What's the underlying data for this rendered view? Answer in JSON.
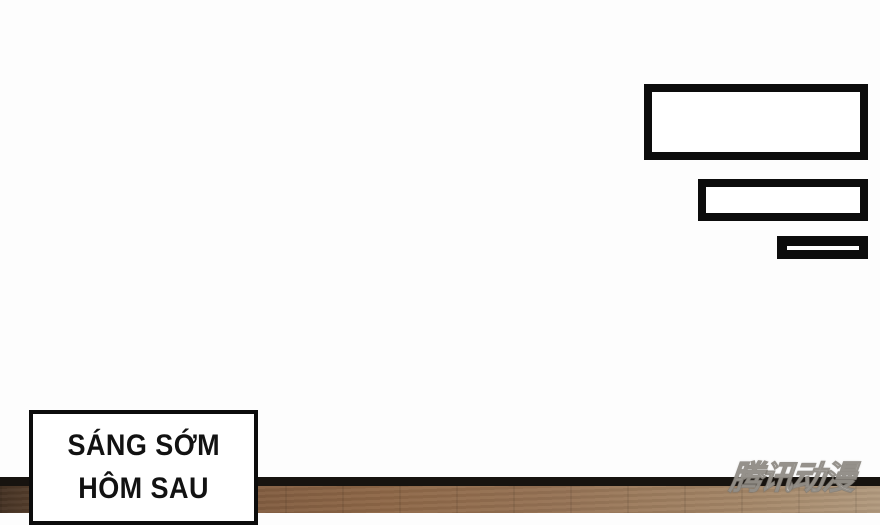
{
  "caption_box": {
    "lines": [
      "SÁNG SỚM",
      "HÔM SAU"
    ]
  },
  "watermark": {
    "text": "腾讯动漫"
  },
  "colors": {
    "ink": "#0c0c0c",
    "paper": "#fdfdfd",
    "band": "#17130f",
    "floor_dark": "#463324",
    "floor_mid": "#8f6848",
    "floor_light": "#b39b7f"
  }
}
